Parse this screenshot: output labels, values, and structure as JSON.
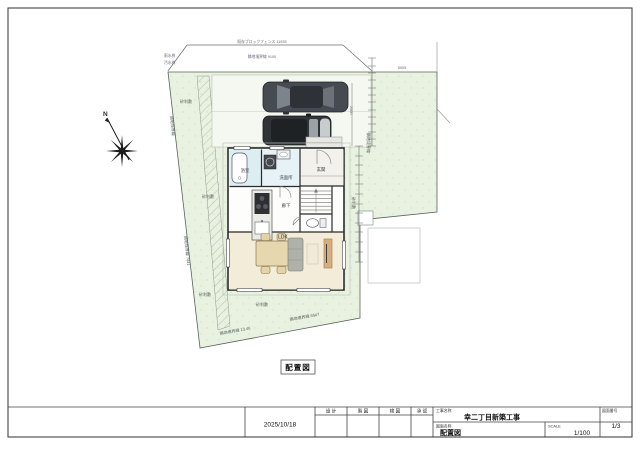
{
  "drawing": {
    "caption": "配置図",
    "north": "N",
    "site": {
      "fence_top_label": "既存ブロックフェンス 11935",
      "road_boundary_label": "隣地境界線 9100",
      "boundary_left_upper": "隣地境界線",
      "boundary_left_lower": "隣地境界線 7441",
      "boundary_right_label": "隣地境界線",
      "boundary_bottom_left": "隣地境界線 13.46",
      "boundary_bottom_right": "隣地境界線 6547",
      "gravel_label": "砂利敷",
      "dim_top_right": "5005",
      "dim_parking": "2500",
      "marker_left_1": "雨水桝",
      "marker_left_2": "汚水桝"
    },
    "rooms": {
      "bath": "浴室",
      "washroom": "洗面所",
      "hall": "廊下",
      "entrance": "玄関",
      "ldk": "LDK"
    }
  },
  "title_block": {
    "date": "2025/10/18",
    "col_design": "設 計",
    "col_draft": "製 図",
    "col_check": "検 図",
    "col_approve": "承 認",
    "project_label": "工事名称",
    "project_name": "幸二丁目新築工事",
    "drawing_label": "図面名称",
    "drawing_name": "配置図",
    "scale_label": "SCALE",
    "scale_value": "1/100",
    "sheet_label": "図面番号",
    "sheet_number": "1/3"
  }
}
